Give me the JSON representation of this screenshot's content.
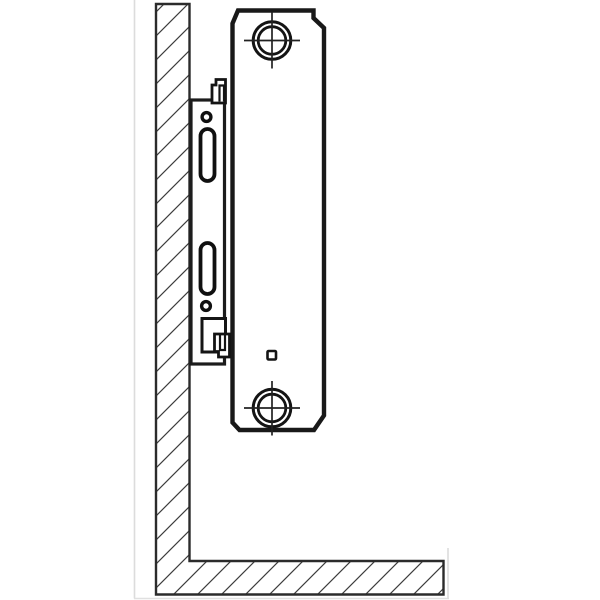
{
  "diagram": {
    "label": "Side-view installation drawing: steel panel radiator hung on a wall-mounted bracket above the floor",
    "canvas": {
      "width": 600,
      "height": 600
    },
    "colors": {
      "background": "#ffffff",
      "ink": "#1b1b1b",
      "wall_outline": "#2b2b2b",
      "hatch": "#3d3d3d",
      "faint_edge": "#dcdcdc"
    },
    "shapes": [
      {
        "tag": "line",
        "name": "photo-edge-left",
        "attrs": {
          "x1": 134.5,
          "y1": 0,
          "x2": 134.5,
          "y2": 598.5,
          "stroke": "#dcdcdc",
          "stroke-width": 1.6
        }
      },
      {
        "tag": "line",
        "name": "photo-edge-bottom",
        "attrs": {
          "x1": 134,
          "y1": 598.5,
          "x2": 449,
          "y2": 598.5,
          "stroke": "#e0e0e0",
          "stroke-width": 1.6
        }
      },
      {
        "tag": "line",
        "name": "photo-edge-right",
        "attrs": {
          "x1": 448,
          "y1": 548,
          "x2": 448,
          "y2": 598.5,
          "stroke": "#dcdcdc",
          "stroke-width": 1.6
        }
      },
      {
        "tag": "path",
        "name": "wall-floor-section",
        "attrs": {
          "d": "M 156,4 H 189.5 V 561 H 443.5 V 594.5 H 156 Z",
          "fill": "url(#hatch)",
          "stroke": "#2b2b2b",
          "stroke-width": 2.4,
          "stroke-linejoin": "miter"
        }
      },
      {
        "tag": "rect",
        "name": "bracket-plate",
        "attrs": {
          "x": 191,
          "y": 100,
          "width": 33.5,
          "height": 264,
          "fill": "#ffffff",
          "stroke": "#1c1c1c",
          "stroke-width": 3.2
        }
      },
      {
        "tag": "circle",
        "name": "bracket-hole-upper",
        "attrs": {
          "cx": 206.5,
          "cy": 117,
          "r": 4.4,
          "fill": "#ffffff",
          "stroke": "#101010",
          "stroke-width": 3.4
        }
      },
      {
        "tag": "rect",
        "name": "bracket-slot-upper",
        "attrs": {
          "x": 200.5,
          "y": 129,
          "width": 14,
          "height": 52,
          "rx": 7,
          "fill": "#ffffff",
          "stroke": "#101010",
          "stroke-width": 3.8
        }
      },
      {
        "tag": "rect",
        "name": "bracket-slot-lower",
        "attrs": {
          "x": 200.5,
          "y": 243,
          "width": 14,
          "height": 51,
          "rx": 7,
          "fill": "#ffffff",
          "stroke": "#101010",
          "stroke-width": 3.8
        }
      },
      {
        "tag": "circle",
        "name": "bracket-hole-lower",
        "attrs": {
          "cx": 206,
          "cy": 306,
          "r": 4.4,
          "fill": "#ffffff",
          "stroke": "#101010",
          "stroke-width": 3.4
        }
      },
      {
        "tag": "rect",
        "name": "bracket-window",
        "attrs": {
          "x": 202,
          "y": 318.5,
          "width": 23.5,
          "height": 33.5,
          "fill": "#ffffff",
          "stroke": "#161616",
          "stroke-width": 3
        }
      },
      {
        "tag": "path",
        "name": "radiator-panel-outline",
        "attrs": {
          "d": "M 238,10.5 H 313.5 V 18 L 324,28 V 415.5 L 314,430 H 239.5 L 232.5,422.5 V 23.5 Z",
          "fill": "#ffffff",
          "stroke": "#191919",
          "stroke-width": 4.4,
          "stroke-linejoin": "miter"
        }
      },
      {
        "tag": "path",
        "name": "hanging-lug-top",
        "attrs": {
          "d": "M 212,103 V 85 H 216 V 79.5 H 225.5 V 103 Z",
          "fill": "#ffffff",
          "stroke": "#141414",
          "stroke-width": 2.8
        }
      },
      {
        "tag": "path",
        "name": "hanging-lug-top-detail",
        "attrs": {
          "d": "M 219.5,101.5 V 85.5 H 224 V 101.5",
          "fill": "none",
          "stroke": "#141414",
          "stroke-width": 2.2
        }
      },
      {
        "tag": "path",
        "name": "hanging-lug-bottom",
        "attrs": {
          "d": "M 214.5,334 V 351.5 H 218.5 V 357 H 229.5 V 334 Z",
          "fill": "#ffffff",
          "stroke": "#141414",
          "stroke-width": 2.8
        }
      },
      {
        "tag": "path",
        "name": "hanging-lug-bottom-detail",
        "attrs": {
          "d": "M 220,334 V 350 H 225 V 334",
          "fill": "none",
          "stroke": "#141414",
          "stroke-width": 2.2
        }
      },
      {
        "tag": "circle",
        "name": "vent-plug-top-ring-outer",
        "attrs": {
          "cx": 272,
          "cy": 40.5,
          "r": 18.8,
          "fill": "#ffffff",
          "stroke": "#141414",
          "stroke-width": 3
        }
      },
      {
        "tag": "circle",
        "name": "vent-plug-top-ring-inner",
        "attrs": {
          "cx": 272,
          "cy": 40.5,
          "r": 13.8,
          "fill": "none",
          "stroke": "#141414",
          "stroke-width": 2.8
        }
      },
      {
        "tag": "line",
        "name": "crosshair-top-vertical",
        "attrs": {
          "x1": 272,
          "y1": 12,
          "x2": 272,
          "y2": 68.5,
          "stroke": "#222222",
          "stroke-width": 1.7
        }
      },
      {
        "tag": "line",
        "name": "crosshair-top-horizontal",
        "attrs": {
          "x1": 244,
          "y1": 40.5,
          "x2": 300,
          "y2": 40.5,
          "stroke": "#222222",
          "stroke-width": 1.7
        }
      },
      {
        "tag": "circle",
        "name": "vent-plug-bottom-ring-outer",
        "attrs": {
          "cx": 272,
          "cy": 408,
          "r": 18.8,
          "fill": "#ffffff",
          "stroke": "#141414",
          "stroke-width": 3
        }
      },
      {
        "tag": "circle",
        "name": "vent-plug-bottom-ring-inner",
        "attrs": {
          "cx": 272,
          "cy": 408,
          "r": 13.8,
          "fill": "none",
          "stroke": "#141414",
          "stroke-width": 2.8
        }
      },
      {
        "tag": "line",
        "name": "crosshair-bottom-vertical",
        "attrs": {
          "x1": 272,
          "y1": 381,
          "x2": 272,
          "y2": 435.5,
          "stroke": "#222222",
          "stroke-width": 1.7
        }
      },
      {
        "tag": "line",
        "name": "crosshair-bottom-horizontal",
        "attrs": {
          "x1": 244,
          "y1": 408,
          "x2": 300,
          "y2": 408,
          "stroke": "#222222",
          "stroke-width": 1.7
        }
      },
      {
        "tag": "rect",
        "name": "drain-square-marker",
        "attrs": {
          "x": 267.5,
          "y": 351,
          "width": 8.5,
          "height": 8.5,
          "rx": 1.2,
          "fill": "#ffffff",
          "stroke": "#141414",
          "stroke-width": 2.6
        }
      }
    ]
  }
}
